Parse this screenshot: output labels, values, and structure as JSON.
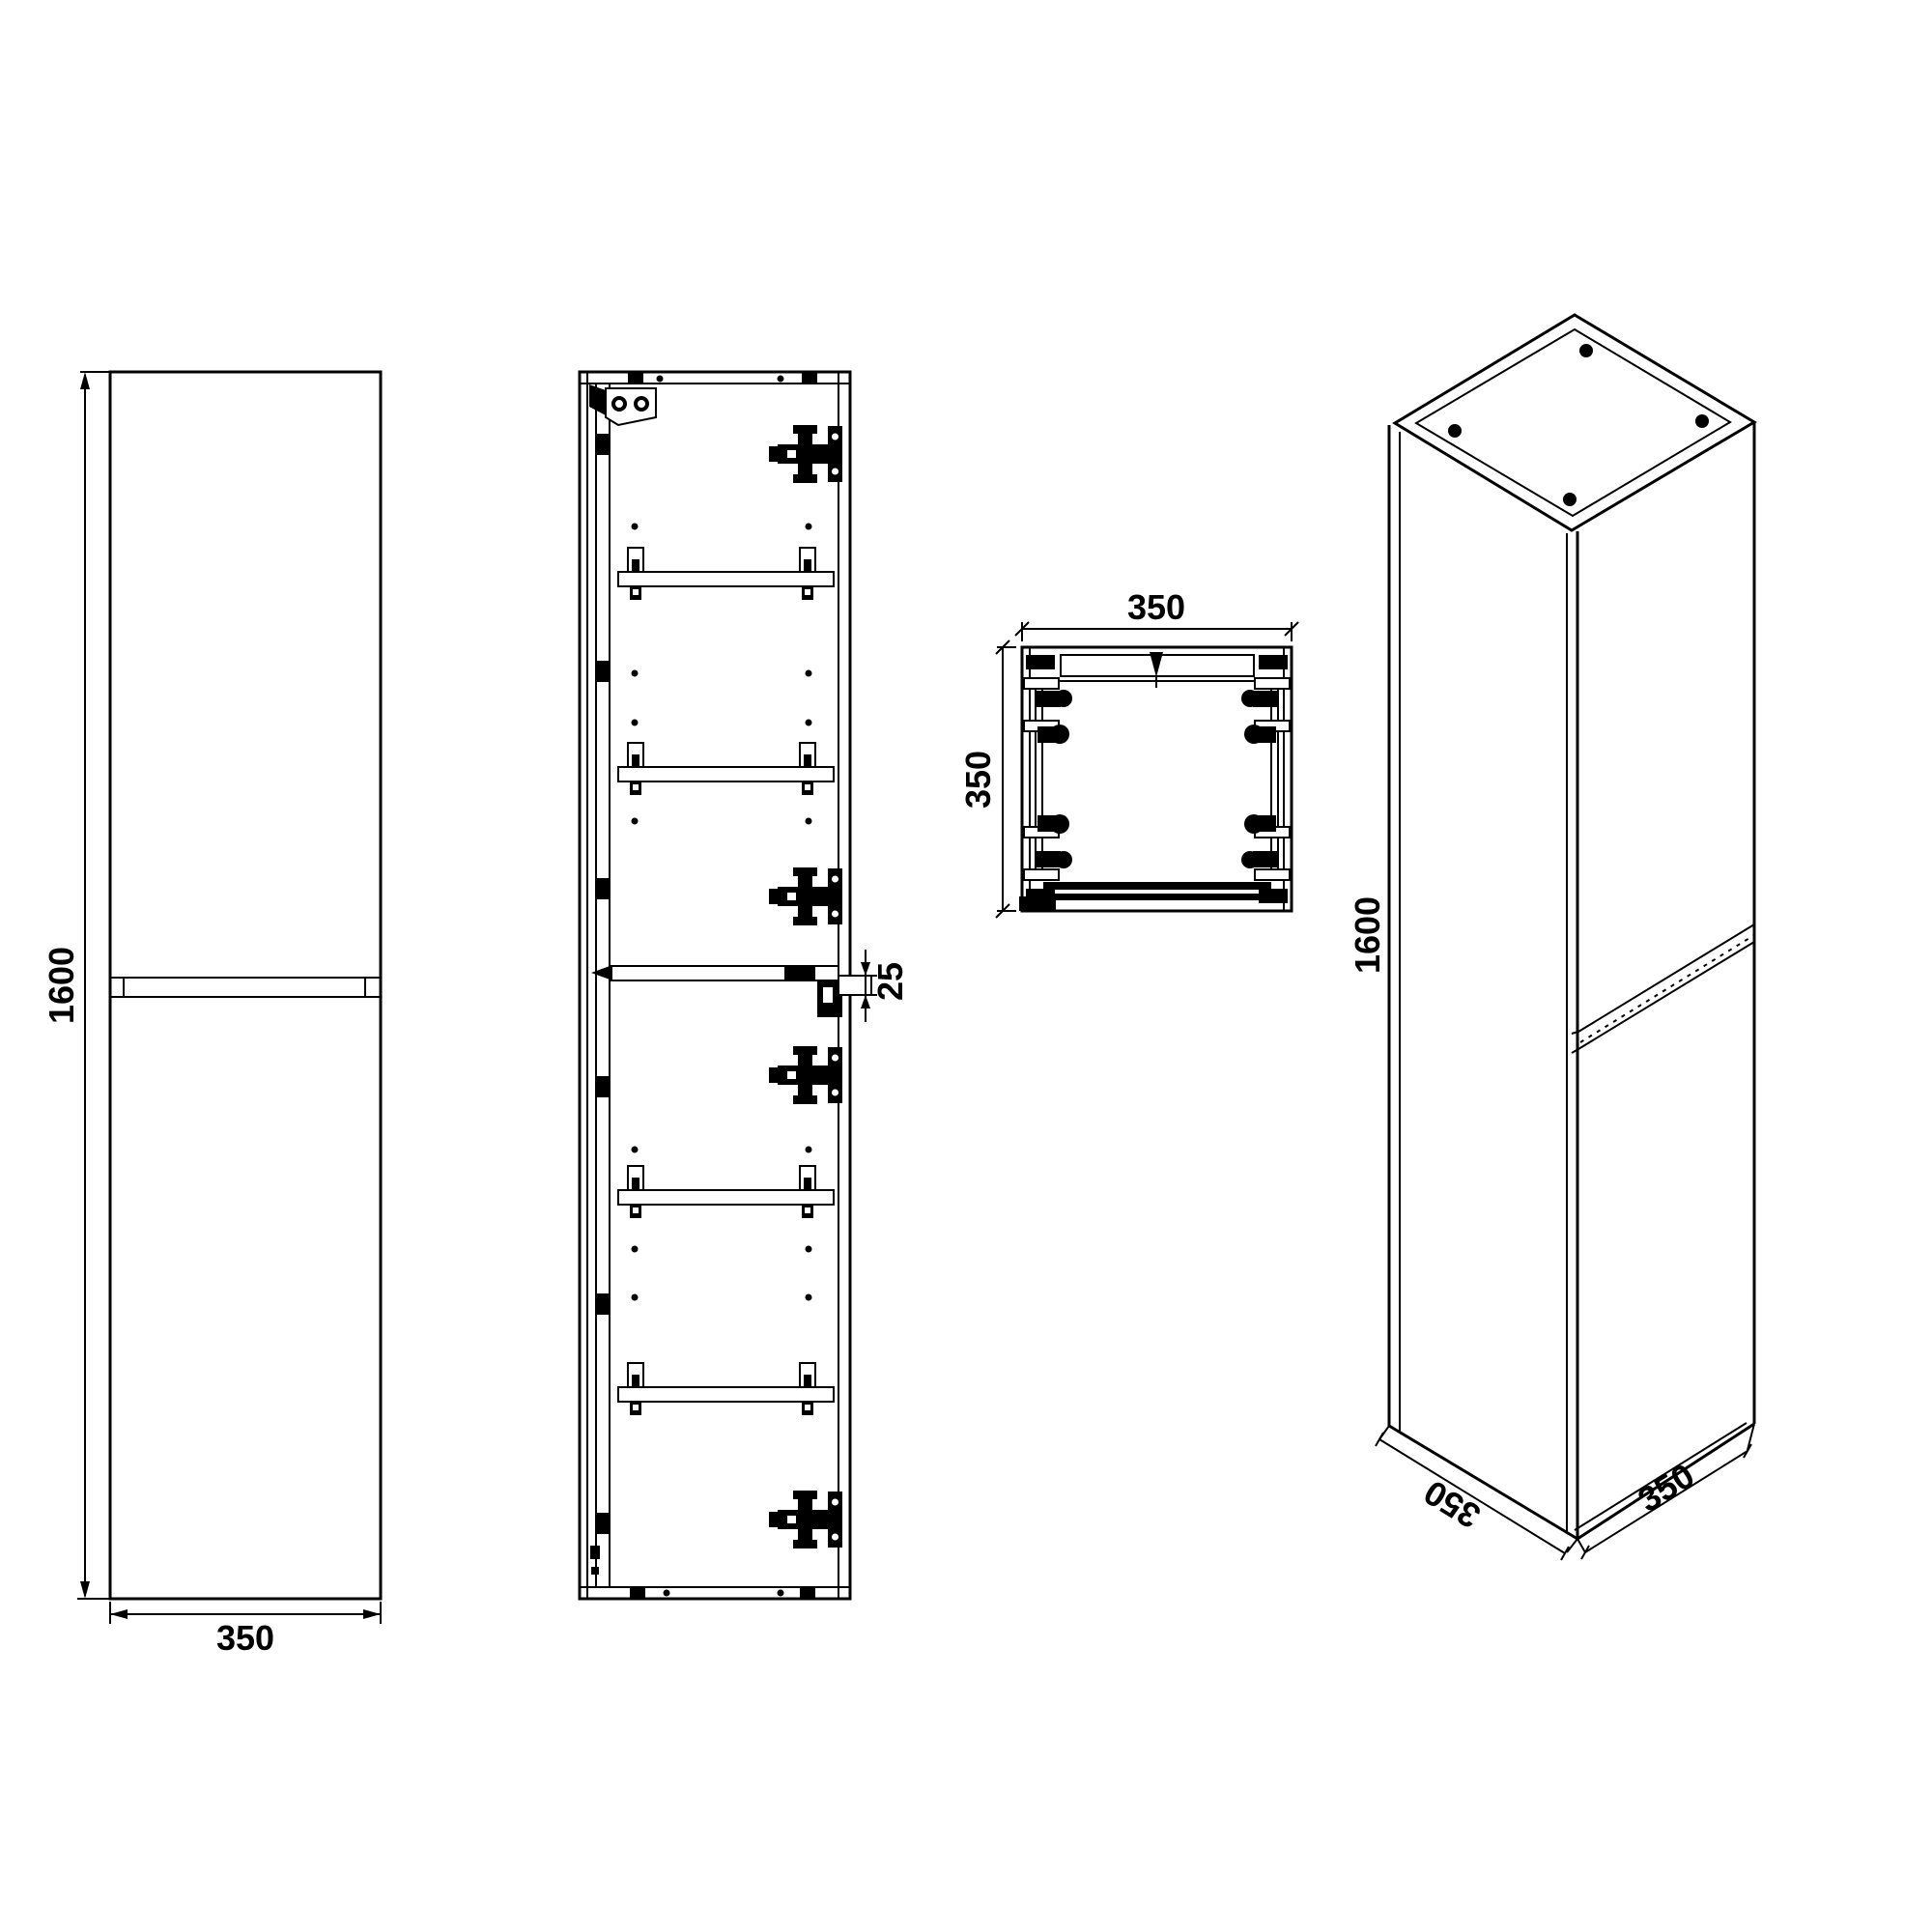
{
  "drawing": {
    "type": "cabinet-technical-drawing",
    "colors": {
      "line": "#000000",
      "background": "#ffffff"
    },
    "views": {
      "front": {
        "height_dim": "1600",
        "width_dim": "350"
      },
      "section": {
        "divider_dim": "25"
      },
      "top": {
        "width_dim": "350",
        "depth_dim": "350"
      },
      "isometric": {
        "height_dim": "1600",
        "depth_dim": "350",
        "width_dim": "350"
      }
    }
  }
}
